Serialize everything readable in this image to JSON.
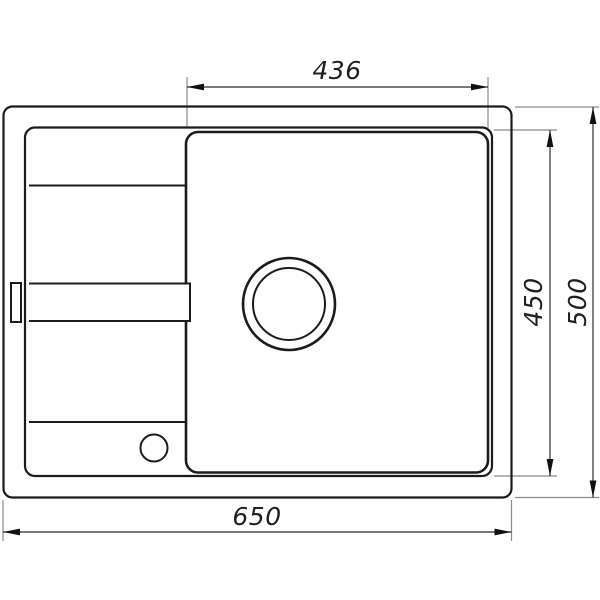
{
  "drawing": {
    "kind": "sink-top-view-dimension-drawing",
    "dims": {
      "top": "436",
      "right_inner": "450",
      "right_outer": "500",
      "bottom": "650"
    },
    "colors": {
      "outline": "#1b1b1b",
      "dimension_line": "#2b2b2b",
      "extension_line": "#8a8a8a",
      "label_text": "#1f1f1f",
      "background": "#ffffff"
    }
  }
}
